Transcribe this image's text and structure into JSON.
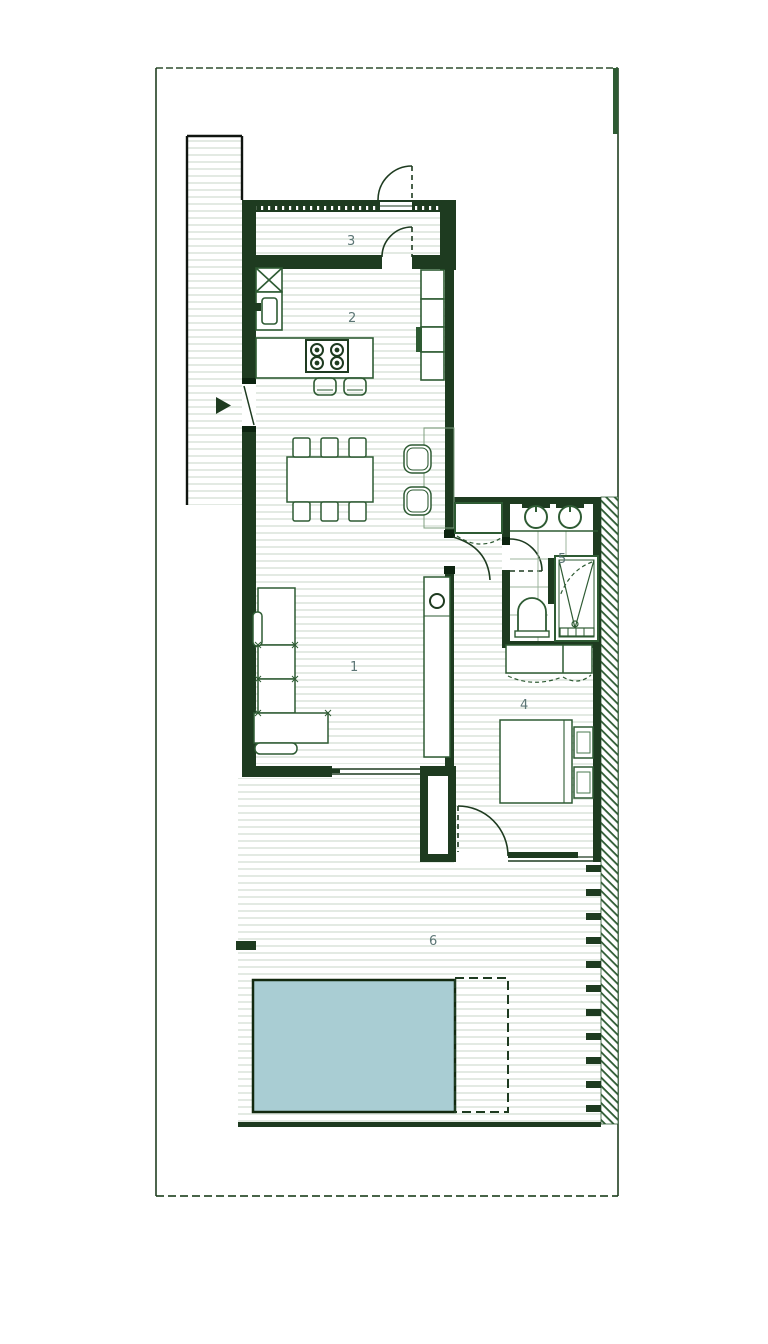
{
  "rooms": {
    "living": {
      "label": "1"
    },
    "kitchen": {
      "label": "2"
    },
    "hall": {
      "label": "3"
    },
    "bedroom": {
      "label": "4"
    },
    "bathroom": {
      "label": "5"
    },
    "terrace": {
      "label": "6"
    }
  },
  "colors": {
    "wall": "#1e3b20",
    "wall_dark": "#0d2410",
    "fixture": "#2e5b33",
    "floor_stripe": "#e3eae3",
    "tile_line": "#9cb49c",
    "hatch_line": "#2e5b33",
    "pool_fill": "#a9cdd3",
    "pool_border": "#12290f",
    "room_label": "#5c7675",
    "boundary": "#2e4f2e"
  }
}
